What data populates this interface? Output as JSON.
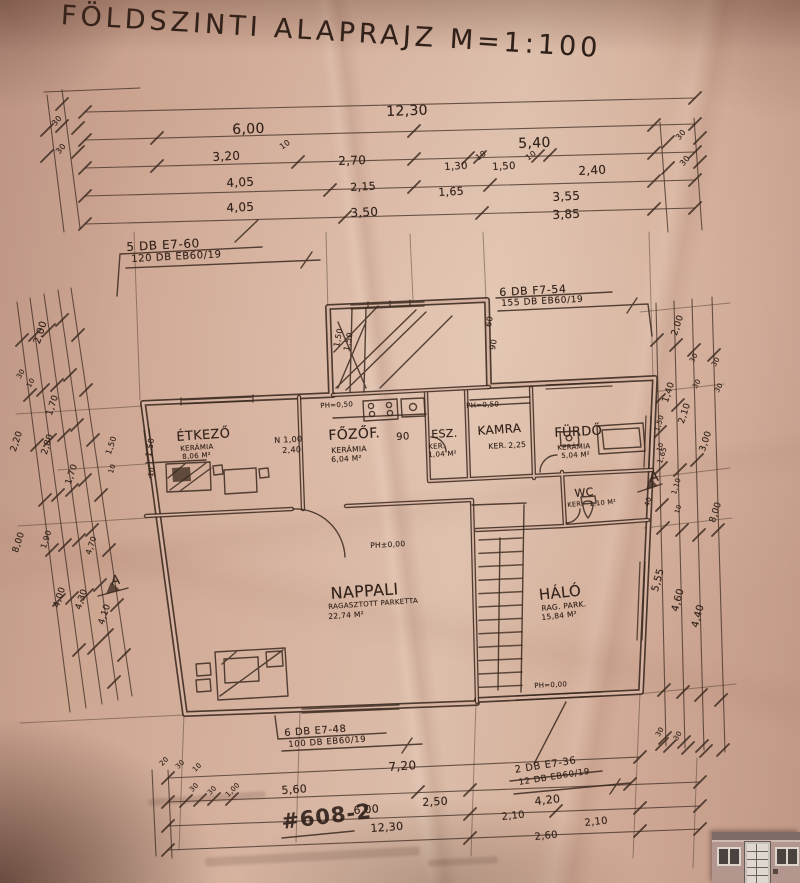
{
  "title": "FÖLDSZINTI ALAPRAJZ M=1:100",
  "stamp": {
    "number": "#608-2"
  },
  "colors": {
    "paper": "#d5b1a0",
    "ink": "#3a281e"
  },
  "beam_notes": {
    "top_left": {
      "l1": "5 DB E7-60",
      "l2": "120 DB EB60/19"
    },
    "top_right": {
      "l1": "6 DB F7-54",
      "l2": "155 DB EB60/19"
    },
    "bottom_center": {
      "l1": "6 DB E7-48",
      "l2": "100 DB EB60/19"
    },
    "bottom_right": {
      "l1": "2 DB E7-36",
      "l2": "12 DB EB60/19"
    }
  },
  "rooms": {
    "etkezo": {
      "name": "ÉTKEZŐ",
      "floor": "KERÁMIA",
      "area": "8,06 M²"
    },
    "fozof": {
      "name": "FŐZŐF.",
      "floor": "KERÁMIA",
      "area": "6,04 M²"
    },
    "esz": {
      "name": "ESZ.",
      "floor": "KER.",
      "area": "1,04 M²"
    },
    "kamra": {
      "name": "KAMRA",
      "floor": "KER.",
      "area": "2,25"
    },
    "furdo": {
      "name": "FÜRDŐ",
      "floor": "KERÁMIA",
      "area": "5,04 M²"
    },
    "wc": {
      "name": "WC",
      "floor": "KER.",
      "area": "1,10 M²"
    },
    "nappali": {
      "name": "NAPPALI",
      "floor": "RAGASZTOTT PARKETTA",
      "area": "22,74 M²"
    },
    "halo": {
      "name": "HÁLÓ",
      "floor": "RAG. PARK.",
      "area": "15,84 M²"
    }
  },
  "levels": {
    "ph_050a": "PH=0,50",
    "ph_050b": "PH=0,50",
    "ph_000": "PH±0,00",
    "ph_000b": "PH=0,00"
  },
  "plan_marks": {
    "door_90": "90",
    "window_n": "N 1,00",
    "window_n2": "2,40",
    "bay_150a": "1,50",
    "bay_150b": "1,50",
    "bay_60": "60",
    "bay_90": "90",
    "wall_150": "1,50",
    "wall_10": "10",
    "section_a_right": "A",
    "section_a_left": "A"
  },
  "top_dims": {
    "total": "12,30",
    "row2": [
      "6,00",
      "5,40"
    ],
    "row3": [
      "3,20",
      "10",
      "2,70",
      "1,30",
      "10",
      "1,50",
      "10",
      "2,40"
    ],
    "row4": [
      "4,05",
      "2,15",
      "1,65",
      "3,55"
    ],
    "row5": [
      "4,05",
      "3,50",
      "3,85"
    ],
    "left_edge": [
      "30",
      "30"
    ],
    "right_edge": [
      "30",
      "30"
    ]
  },
  "bottom_dims": {
    "row1": [
      "7,20"
    ],
    "row2": [
      "5,60",
      "2,50",
      "4,20"
    ],
    "row3": [
      "6,00",
      "2,10",
      "2,10"
    ],
    "row4": [
      "12,30",
      "2,60"
    ],
    "left_edge": [
      "20",
      "30",
      "10",
      "30",
      "30",
      "1,00"
    ]
  },
  "left_dims": [
    "2,00",
    "30",
    "10",
    "1,70",
    "2,20",
    "2,80",
    "1,70",
    "1,50",
    "10",
    "8,00",
    "1,90",
    "4,70",
    "4,00",
    "4,30",
    "4,10"
  ],
  "right_dims": [
    "2,00",
    "30",
    "30",
    "30",
    "30",
    "1,40",
    "2,10",
    "3,00",
    "1,50",
    "10",
    "1,65",
    "1,10",
    "10",
    "40",
    "8,00",
    "5,55",
    "4,60",
    "4,40",
    "30",
    "30"
  ]
}
